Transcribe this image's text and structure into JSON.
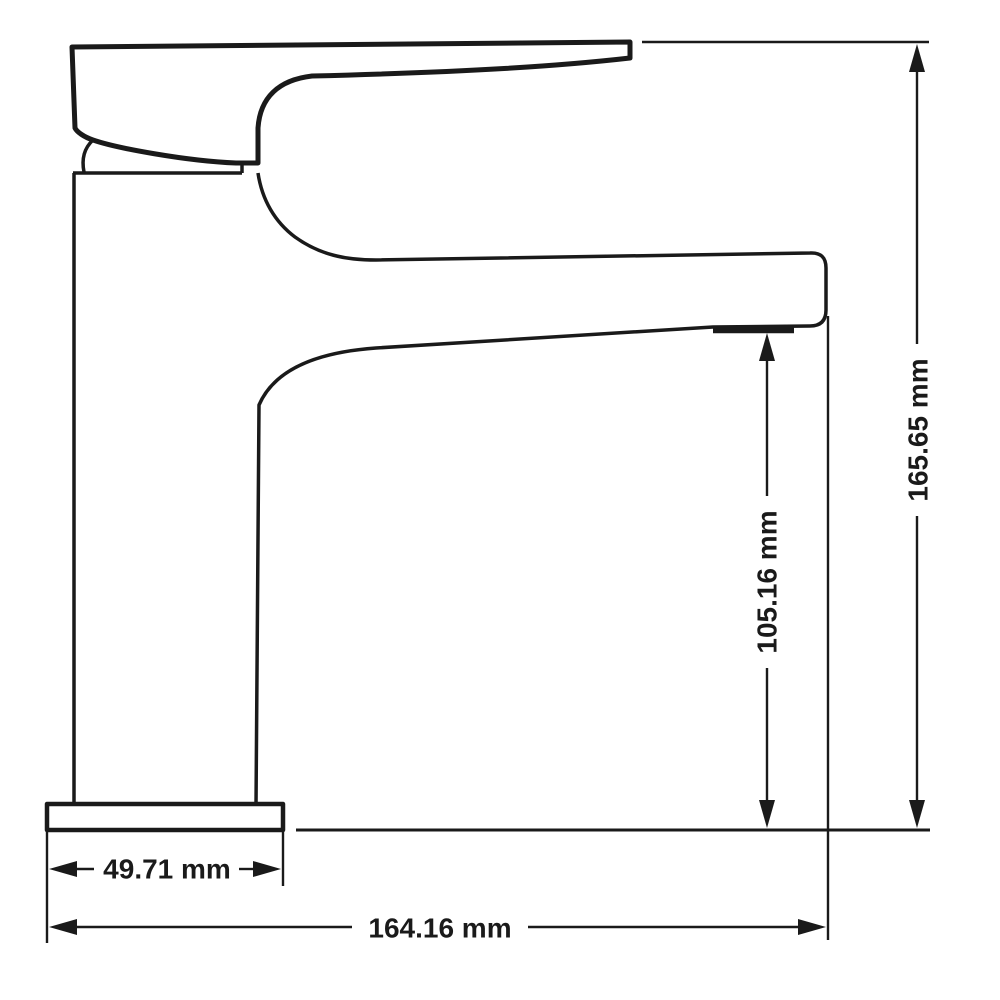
{
  "drawing": {
    "dimensions": {
      "base_width": "49.71 mm",
      "total_width": "164.16 mm",
      "spout_height": "105.16 mm",
      "total_height": "165.65 mm"
    },
    "colors": {
      "line": "#1a1a1a",
      "background": "#ffffff"
    }
  }
}
